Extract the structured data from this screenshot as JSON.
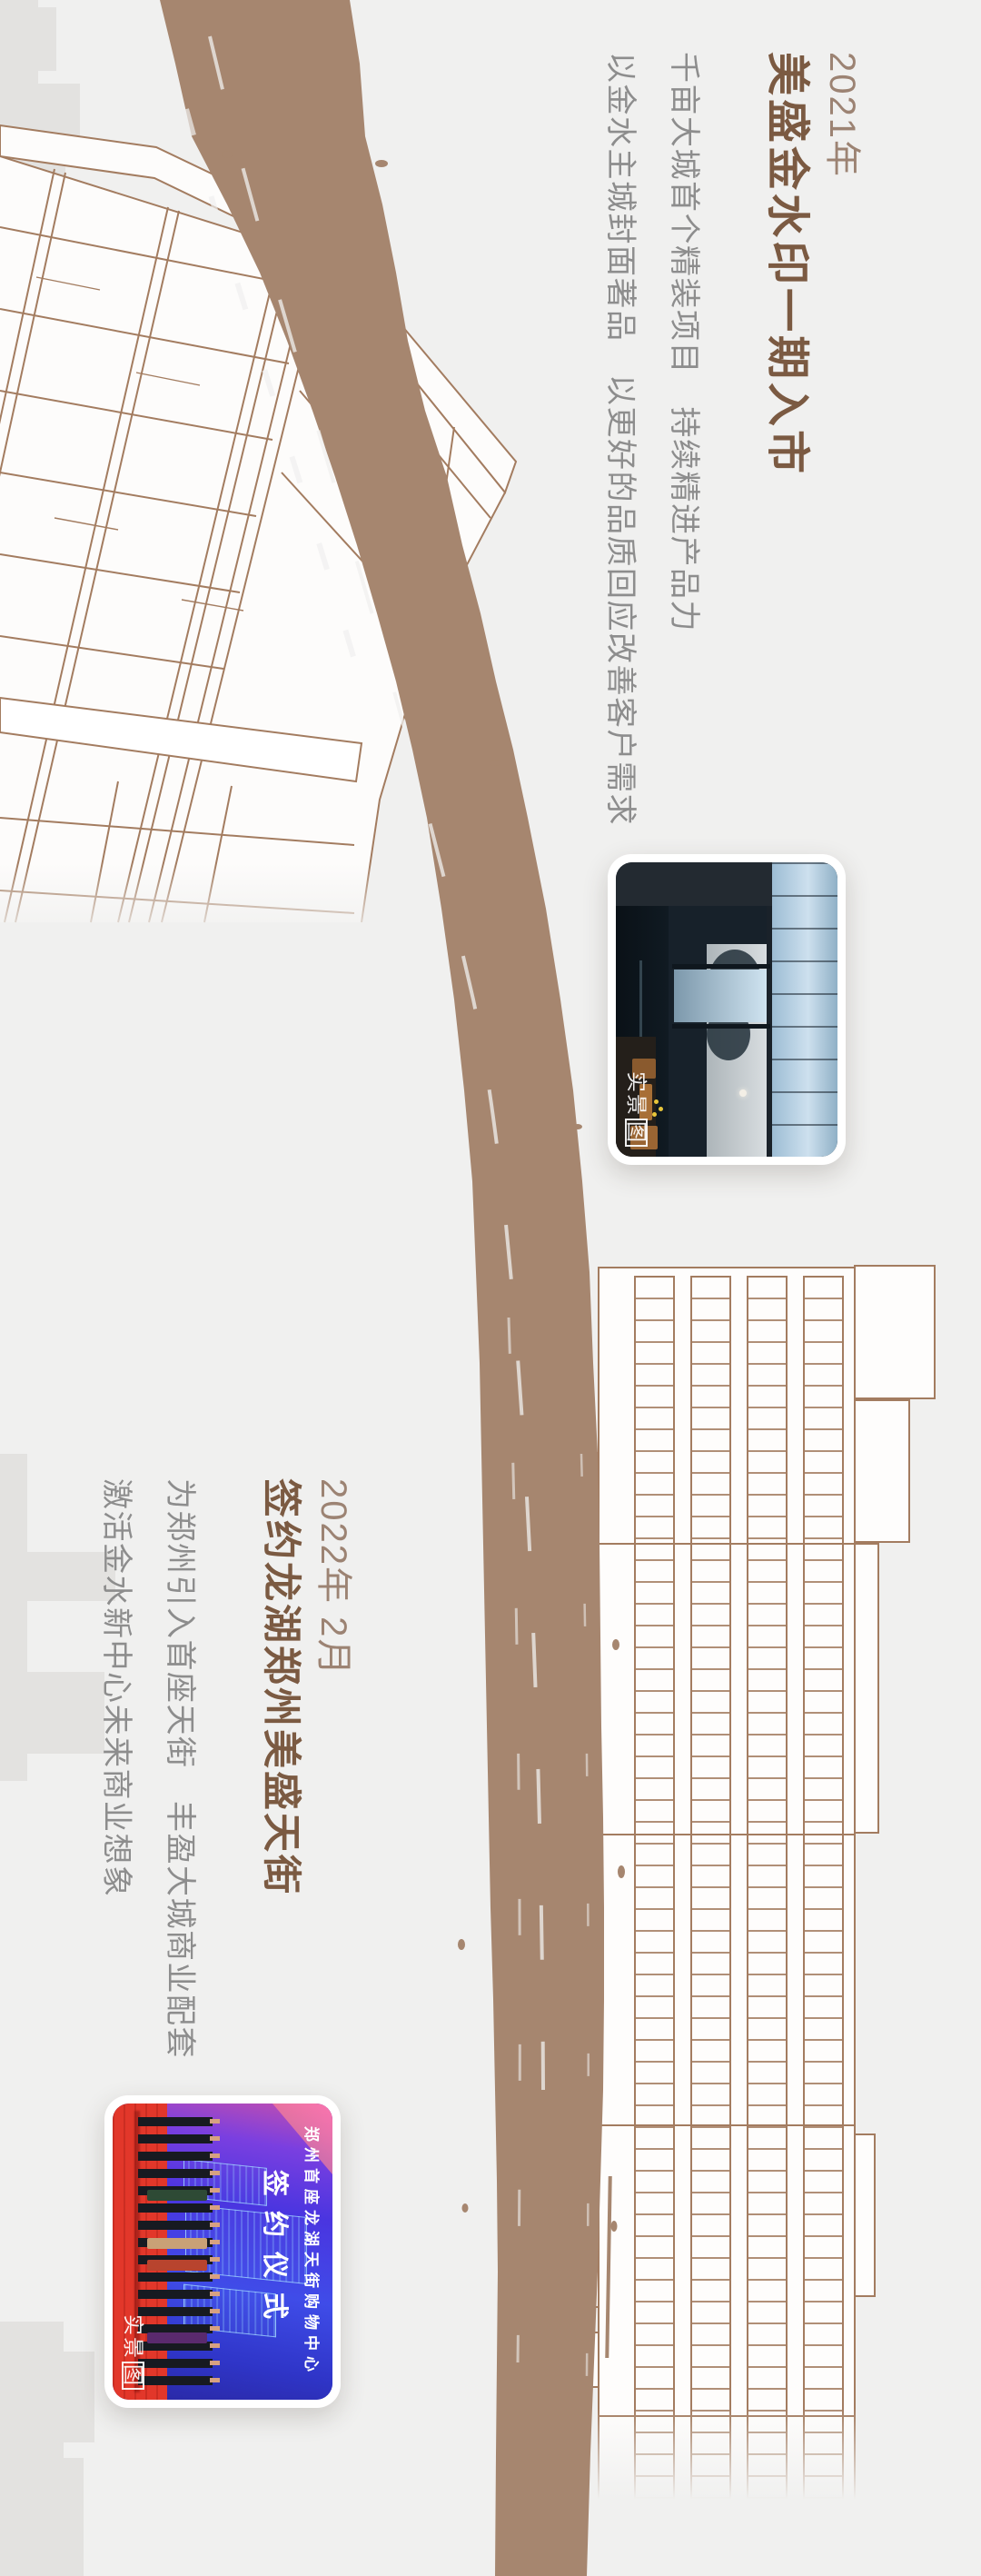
{
  "canvas": {
    "background": "#f0f0ef"
  },
  "palette": {
    "brush_brown": "#a6866f",
    "line_brown": "#a37c60",
    "title_brown": "#7b5a42",
    "year_brown": "#9c8373",
    "body_gray": "#8d8d8d",
    "silhouette_gray": "#e3e2e0",
    "photo_border": "#ffffff"
  },
  "sections": [
    {
      "year": "2021年",
      "title": "美盛金水印一期入市",
      "body_lines": [
        "千亩大城首个精装项目　持续精进产品力",
        "以金水主城封面著品　以更好的品质回应改善客户需求"
      ]
    },
    {
      "year": "2022年 2月",
      "title": "签约龙湖郑州美盛天街",
      "body_lines": [
        "为郑州引入首座天街　丰盈大城商业配套",
        "激活金水新中心未来商业想象"
      ]
    }
  ],
  "photos": [
    {
      "watermark": {
        "text": "实景",
        "boxed": "图"
      }
    },
    {
      "watermark": {
        "text": "实景",
        "boxed": "图"
      },
      "screen": {
        "line1": "郑州首座龙湖天街购物中心",
        "line2": "签约仪式"
      }
    }
  ]
}
